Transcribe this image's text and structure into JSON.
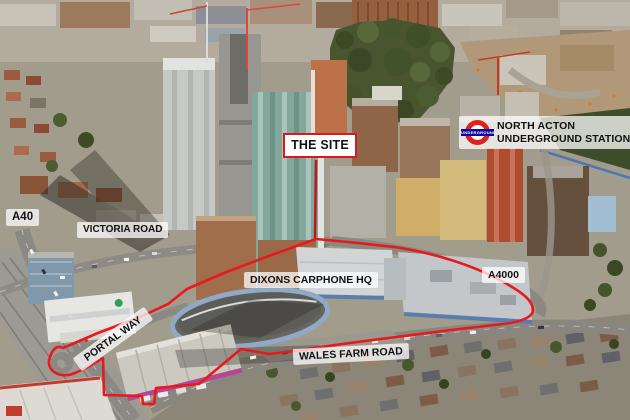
{
  "colors": {
    "annotation_red": "#E8191D",
    "leader_red": "#C0161A",
    "label_bg": "rgba(255,255,255,0.74)",
    "label_text": "#121212",
    "site_label_bg": "#FFFFFF",
    "site_label_border": "#D71920",
    "roundel_red": "#DC241F",
    "roundel_blue": "#10069F"
  },
  "labels": {
    "the_site": "THE SITE",
    "station_line1": "NORTH ACTON",
    "station_line2": "UNDERGROUND STATION",
    "roundel_text": "UNDERGROUND",
    "a40": "A40",
    "victoria_road": "VICTORIA ROAD",
    "dixons_hq": "DIXONS CARPHONE HQ",
    "a4000": "A4000",
    "portal_way": "PORTAL WAY",
    "wales_farm_road": "WALES FARM ROAD"
  }
}
